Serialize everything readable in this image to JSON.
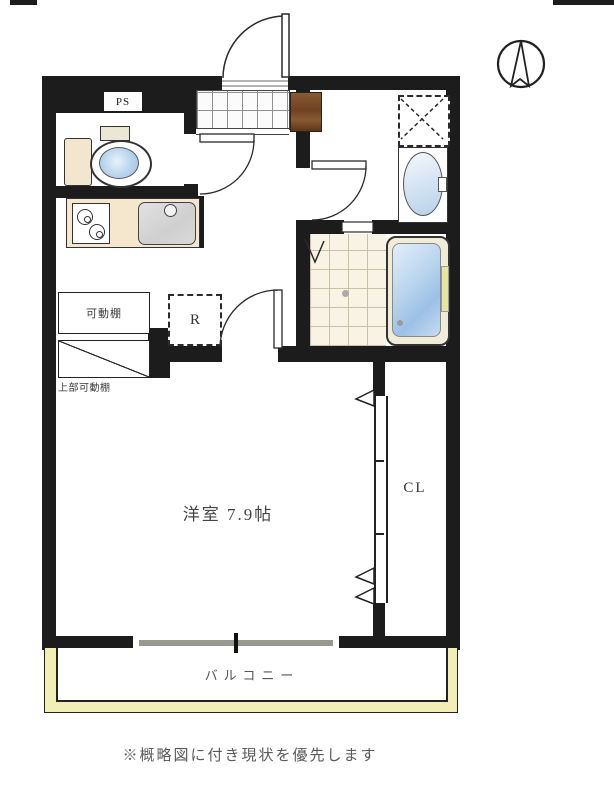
{
  "floorplan": {
    "ps_label": "PS",
    "refrigerator_label": "R",
    "movable_shelf_label": "可動棚",
    "upper_movable_shelf_label": "上部可動棚",
    "main_room_label": "洋室 7.9帖",
    "closet_label": "CL",
    "balcony_label": "バルコニー"
  },
  "note": "※概略図に付き現状を優先します",
  "colors": {
    "wall": "#1c1c1c",
    "balcony_frame": "#f1efb5",
    "water_blue": "#9cc0e6",
    "kitchen_counter": "#f5e7cd",
    "shoe_cabinet": "#7b4b28",
    "tile_floor": "#f8f3e4"
  }
}
